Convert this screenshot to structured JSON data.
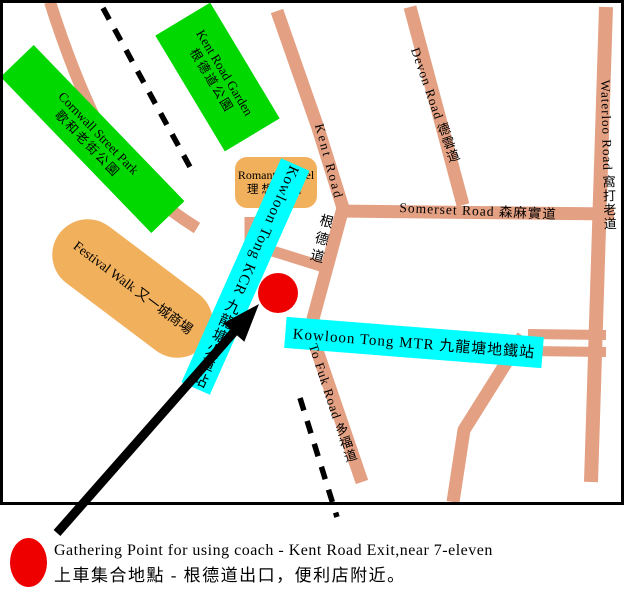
{
  "map": {
    "colors": {
      "road": "#E3A083",
      "park": "#00D800",
      "landmark": "#F1B05C",
      "station": "#00FFFF",
      "marker": "#EE0000",
      "border": "#000000",
      "background": "#FFFFFF"
    },
    "parks": [
      {
        "label_en": "Cornwall Street Park",
        "label_zh": "歌和老街公園"
      },
      {
        "label_en": "Kent Road Garden",
        "label_zh": "根德道公園"
      }
    ],
    "landmarks": [
      {
        "label_en": "Romantic Hotel",
        "label_zh": "理想酒店"
      },
      {
        "label_en": "Festival Walk",
        "label_zh": "又一城商場"
      }
    ],
    "stations": [
      {
        "label": "Kowloon Tong KCR 九龍塘火車站"
      },
      {
        "label": "Kowloon Tong MTR 九龍塘地鐵站"
      }
    ],
    "roads": [
      {
        "label": "Kent Road"
      },
      {
        "label": "根德道"
      },
      {
        "label": "Devon Road 德雲道"
      },
      {
        "label": "Waterloo Road 窩打老道"
      },
      {
        "label": "Somerset Road 森麻實道"
      },
      {
        "label": "To Fuk Road 多福道"
      }
    ]
  },
  "caption": {
    "line1": "Gathering Point for using coach - Kent Road Exit,near 7-eleven",
    "line2": "上車集合地點 - 根德道出口，便利店附近。"
  }
}
